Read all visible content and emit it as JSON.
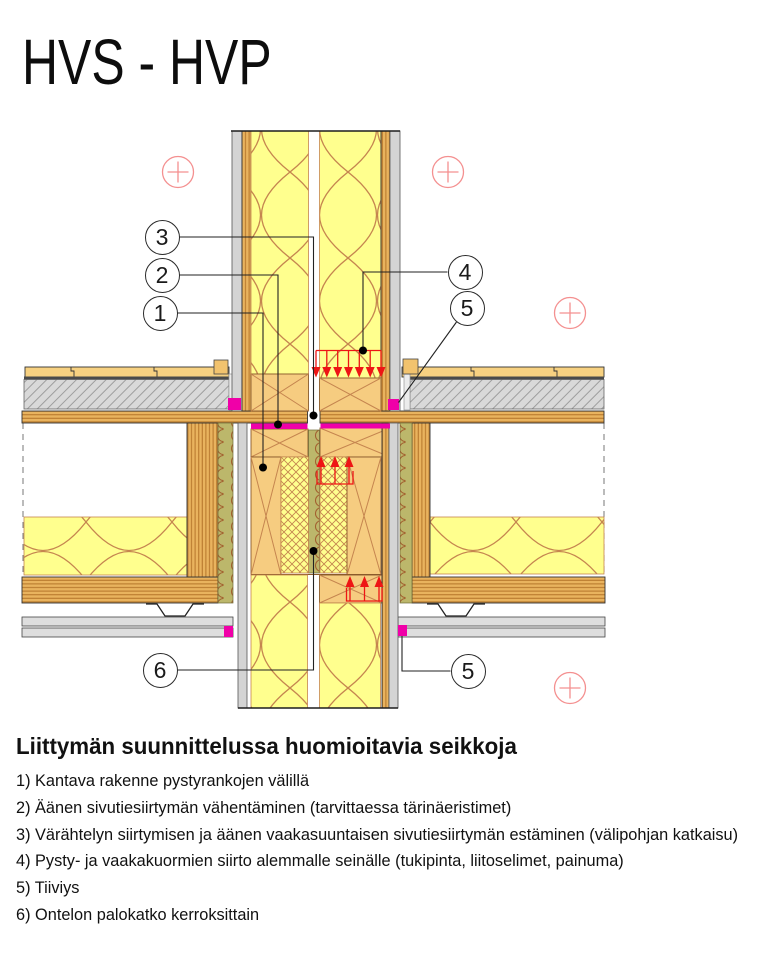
{
  "title": "HVS - HVP",
  "notes": {
    "heading": "Liittymän suunnittelussa huomioitavia seikkoja",
    "items": [
      "1) Kantava rakenne pystyrankojen välillä",
      "2) Äänen sivutiesiirtymän vähentäminen (tarvittaessa tärinäeristimet)",
      "3) Värähtelyn siirtymisen ja äänen vaakasuuntaisen sivutiesiirtymän estäminen (välipohjan katkaisu)",
      "4) Pysty- ja vaakakuormien siirto alemmalle seinälle (tukipinta, liitoselimet, painuma)",
      "5) Tiiviys",
      "6) Ontelon palokatko kerroksittain"
    ]
  },
  "drawing": {
    "callouts": {
      "c1": "1",
      "c2": "2",
      "c3": "3",
      "c4": "4",
      "c5_top": "5",
      "c6": "6",
      "c5_bottom": "5"
    },
    "colors": {
      "magenta": "#f000a8",
      "load-red": "#ee1515",
      "mark-red": "#f49090",
      "insulation-yellow": "#ffff8e",
      "insulation-line": "#c5854f",
      "wood-tan": "#f6cc80",
      "wood-stripe": "#e9b35e",
      "stripe-line": "#b97a2e",
      "board-gray": "#d4d4d4",
      "screed-gray": "#d9d9d9",
      "gypsum-green": "#bcb76b"
    }
  }
}
